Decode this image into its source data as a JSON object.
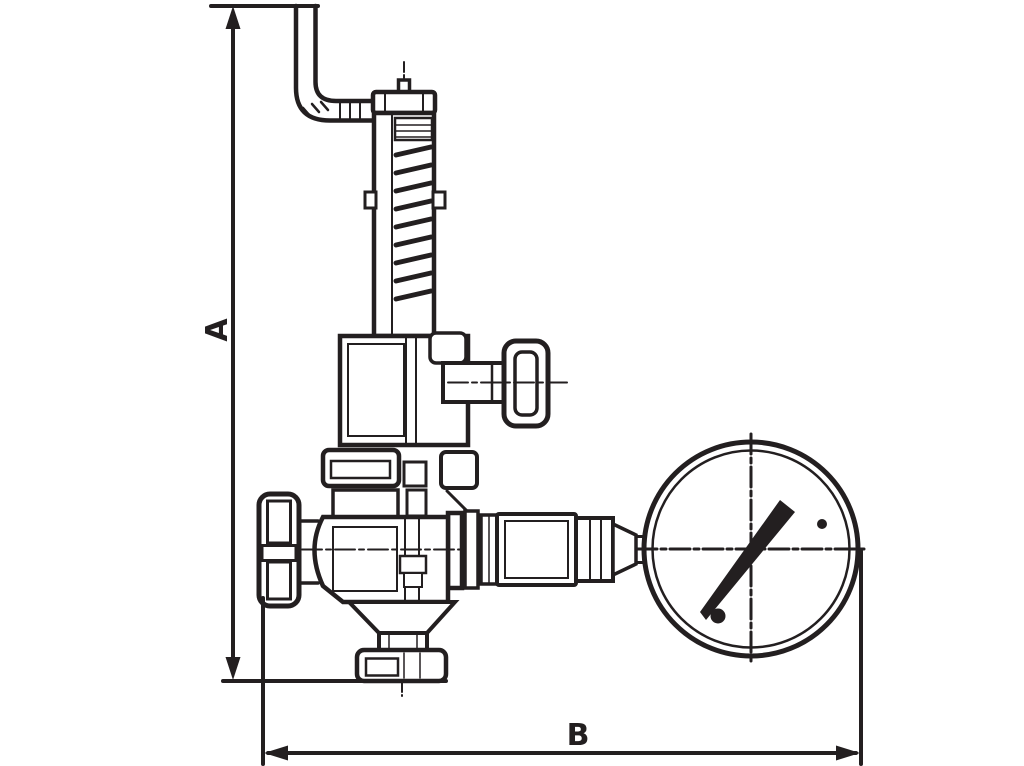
{
  "figure": {
    "background": "#ffffff",
    "ink": "#231f20",
    "dimension_labels": {
      "a": "A",
      "b": "B"
    },
    "parts": [
      "vent-pipe-elbow",
      "adjusting-cap",
      "spring-housing",
      "spring",
      "bonnet",
      "test-knob",
      "bonnet-flange",
      "handwheel",
      "valve-body",
      "outlet-neck",
      "outlet-flange",
      "gauge-piping",
      "pressure-gauge",
      "gauge-needle"
    ]
  }
}
